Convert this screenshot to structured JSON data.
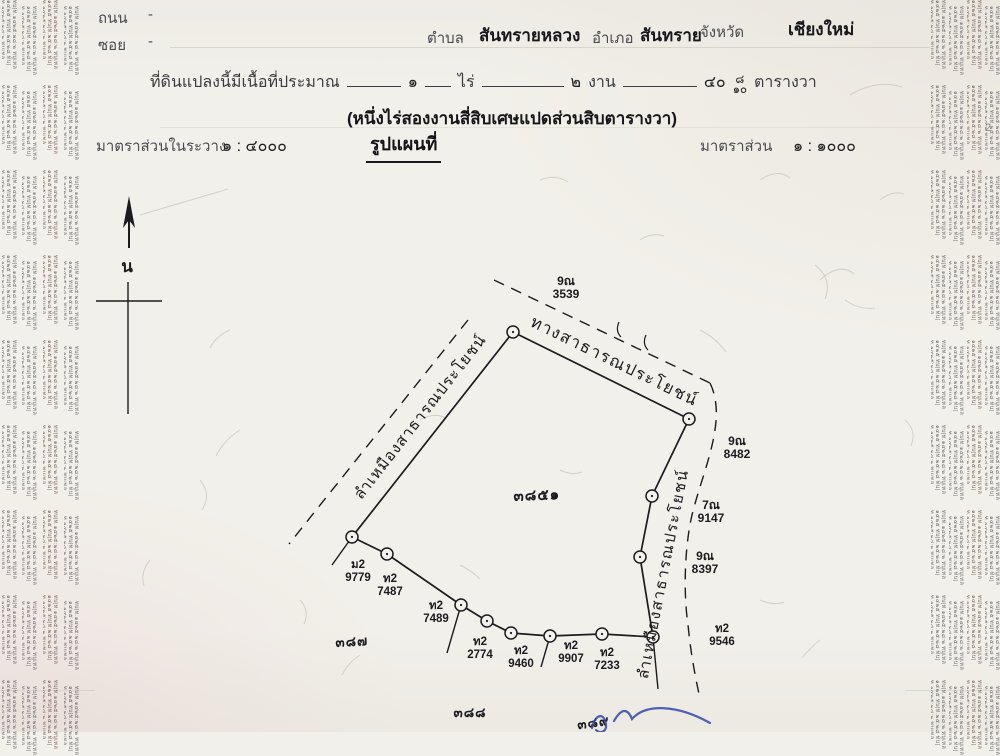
{
  "header": {
    "road_label": "ถนน",
    "road_value": "-",
    "soi_label": "ซอย",
    "soi_value": "-",
    "tambon_label": "ตำบล",
    "tambon": "สันทรายหลวง",
    "amphoe_label": "อำเภอ",
    "amphoe": "สันทราย",
    "province_label": "จังหวัด",
    "province": "เชียงใหม่",
    "area_prefix": "ที่ดินแปลงนี้มีเนื้อที่ประมาณ",
    "area_rai": "๑",
    "rai_label": "ไร่",
    "area_ngan": "๒",
    "ngan_label": "งาน",
    "area_wa": "๔๐",
    "wa_frac_top": "๘",
    "wa_frac_bottom": "๑๐",
    "wa_label": "ตารางวา",
    "area_words": "(หนึ่งไร่สองงานสี่สิบเศษแปดส่วนสิบตารางวา)",
    "scale_sheet_label": "มาตราส่วนในระวาง",
    "scale_sheet_value": "๑ : ๔๐๐๐",
    "map_title": "รูปแผนที่",
    "scale_label": "มาตราส่วน",
    "scale_value": "๑ : ๑๐๐๐",
    "page_mark": "2"
  },
  "compass": {
    "label": "น",
    "arrow": {
      "x": 129,
      "y_tail": 248,
      "y_head": 208
    },
    "arrow_head": "129,196 123,228 129,220 135,228",
    "label_x": 127,
    "label_y": 272,
    "cross_v": [
      128,
      282,
      128,
      414
    ],
    "cross_h": [
      96,
      301,
      162,
      301
    ]
  },
  "map": {
    "parcel_label": {
      "text": "๓๘๕๑",
      "x": 537,
      "y": 500,
      "size": 15,
      "rot": -2
    },
    "neighbor_parcels": [
      {
        "text": "๓๘๗",
        "x": 352,
        "y": 646,
        "size": 13.5,
        "rot": -3
      },
      {
        "text": "๓๘๘",
        "x": 470,
        "y": 717,
        "size": 13.5,
        "rot": 0
      },
      {
        "text": "๓๘๙",
        "x": 594,
        "y": 727,
        "size": 13.5,
        "rot": -8
      }
    ],
    "boundary": [
      [
        513,
        332
      ],
      [
        689,
        419
      ],
      [
        652,
        496
      ],
      [
        640,
        557
      ],
      [
        653,
        637
      ],
      [
        602,
        634
      ],
      [
        550,
        636
      ],
      [
        511,
        633
      ],
      [
        487,
        621
      ],
      [
        461,
        605
      ],
      [
        387,
        554
      ],
      [
        352,
        537
      ]
    ],
    "spurs": [
      [
        [
          352,
          537
        ],
        [
          332,
          565
        ]
      ],
      [
        [
          461,
          605
        ],
        [
          447,
          653
        ]
      ],
      [
        [
          550,
          636
        ],
        [
          541,
          667
        ]
      ],
      [
        [
          653,
          637
        ],
        [
          658,
          689
        ]
      ]
    ],
    "dashed": [
      "M494,280 L710,383",
      "M468,320 L289,544",
      "M710,383 C728,420 703,470 692,515 C685,545 683,590 688,625 C691,655 695,675 699,694"
    ],
    "ticks": [
      "M619,322 q-4,9 2,15",
      "M646,335 q-4,9 2,15"
    ],
    "street_labels": [
      {
        "text": "ทางสาธารณประโยชน์",
        "x": 612,
        "y": 366,
        "rot": 26,
        "size": 16.5,
        "ls": 1.5
      },
      {
        "text": "ลำเหมืองสาธารณประโยชน์",
        "x": 424,
        "y": 420,
        "rot": -52,
        "size": 15.5,
        "ls": 1
      },
      {
        "text": "ลำเหมืองสาธารณประโยชน์",
        "x": 668,
        "y": 575,
        "rot": -79,
        "size": 15.5,
        "ls": 1.5
      }
    ],
    "survey_points": [
      {
        "code": "ม2",
        "num": "9779",
        "x": 358,
        "y": 568
      },
      {
        "code": "ท2",
        "num": "7487",
        "x": 390,
        "y": 582
      },
      {
        "code": "ท2",
        "num": "7489",
        "x": 436,
        "y": 609
      },
      {
        "code": "ท2",
        "num": "2774",
        "x": 480,
        "y": 645
      },
      {
        "code": "ท2",
        "num": "9460",
        "x": 521,
        "y": 654
      },
      {
        "code": "ท2",
        "num": "9907",
        "x": 571,
        "y": 649
      },
      {
        "code": "ท2",
        "num": "7233",
        "x": 607,
        "y": 656
      },
      {
        "code": "ท2",
        "num": "9546",
        "x": 722,
        "y": 632
      }
    ],
    "neighbor_points": [
      {
        "code": "9ณ",
        "num": "3539",
        "x": 566,
        "y": 285
      },
      {
        "code": "9ณ",
        "num": "8482",
        "x": 737,
        "y": 445
      },
      {
        "code": "7ณ",
        "num": "9147",
        "x": 711,
        "y": 509
      },
      {
        "code": "9ณ",
        "num": "8397",
        "x": 705,
        "y": 560
      }
    ]
  },
  "annotations": {
    "pen_color": "#3347a8",
    "pen_paths": [
      "M592,728 c3,-14 12,-16 14,-4 c1,8 -6,10 -10,6",
      "M614,721 c8,-14 14,-12 18,-2 c14,-16 46,-14 78,4"
    ]
  },
  "margins": {
    "microtext": "ทบ|ท.๑๔๒๕:๒๘:๒ ทบูเทล ๑๔๒๕ ทบ|ท.๒๕:๒๘ ทบ|ท.๑๔๒๕:๒๘:๒ ทบูเทล",
    "left_x": [
      2,
      22,
      43,
      64
    ],
    "right_x": [
      931,
      949,
      967,
      985
    ],
    "colors": [
      "#55525a",
      "#5a5560",
      "#6b4a48",
      "#55525a"
    ]
  }
}
